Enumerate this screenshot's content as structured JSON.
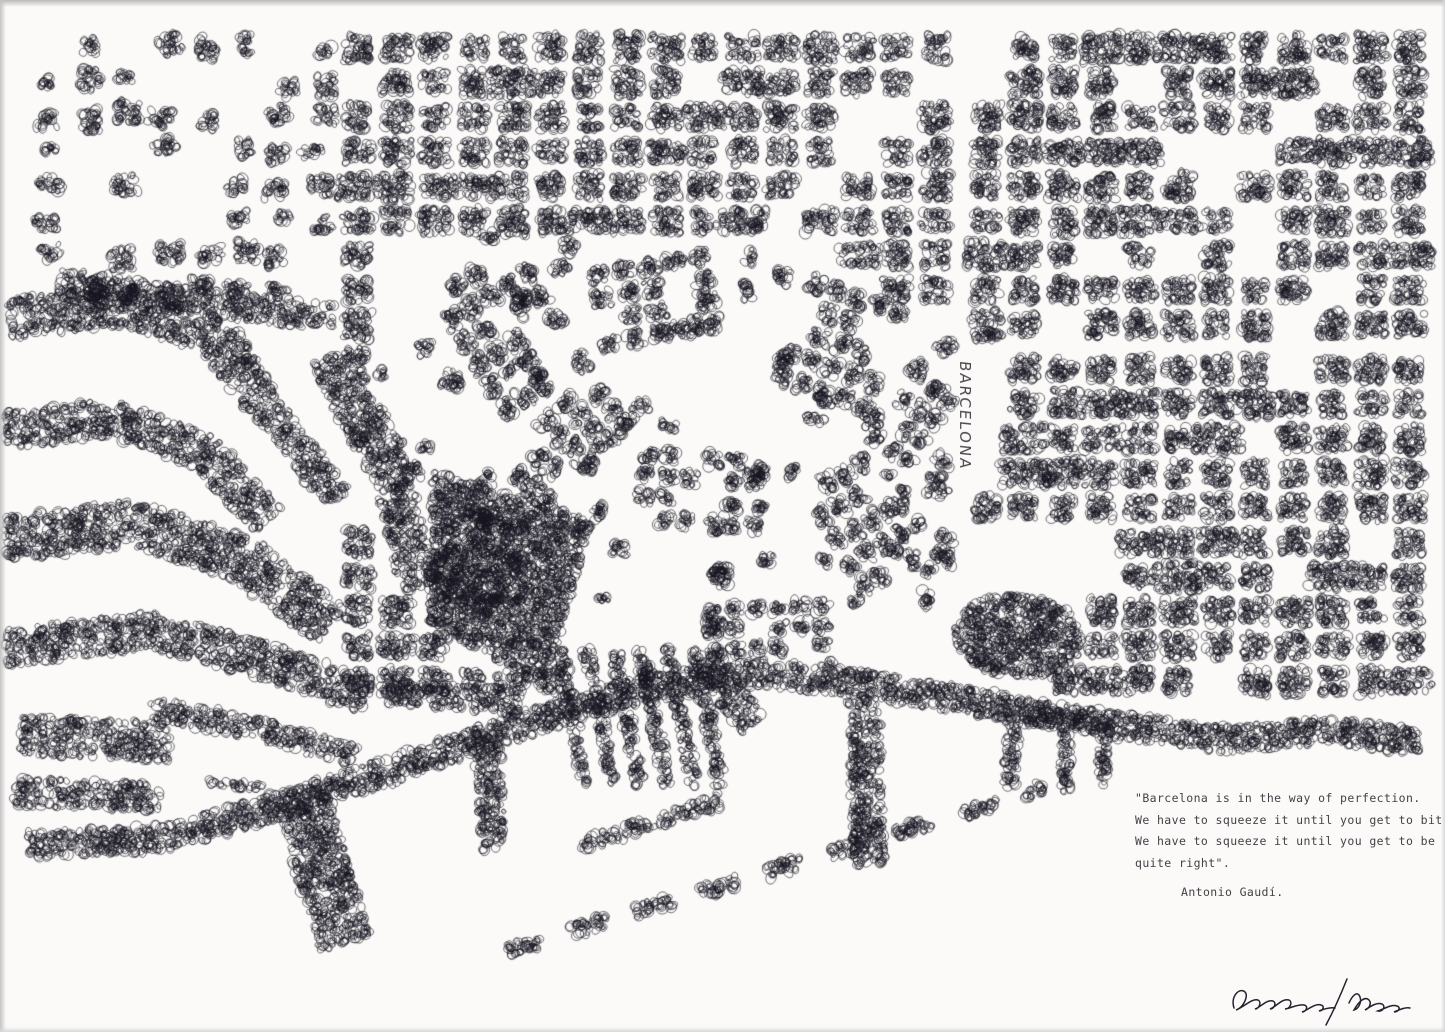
{
  "artwork": {
    "map_label": "BARCELONA",
    "quote": {
      "line1": "\"Barcelona is in the way of perfection.",
      "line2": "We have to squeeze it until you get to bit",
      "line3": "We have to squeeze it until you get to be",
      "line4": "quite right\".",
      "attribution": "Antonio Gaudí."
    },
    "colors": {
      "paper": "#fbfaf8",
      "ink": "#171520",
      "typewriter_ink": "#434147",
      "scan_edge": "#b9b9b9"
    }
  }
}
